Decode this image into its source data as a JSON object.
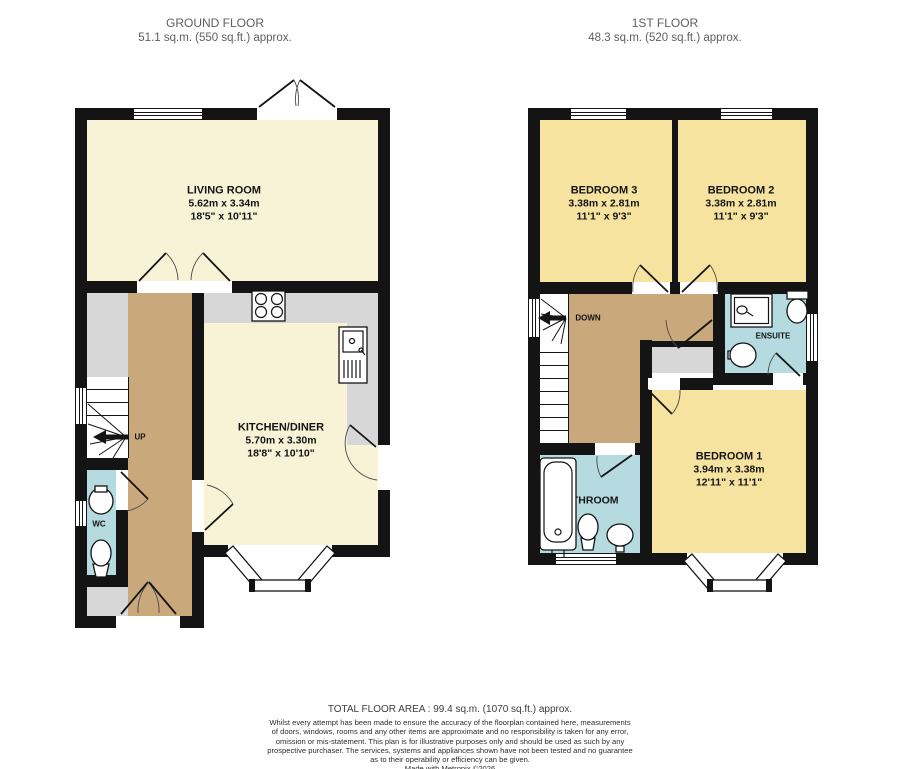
{
  "headers": {
    "ground": {
      "title": "GROUND FLOOR",
      "area": "51.1 sq.m. (550 sq.ft.) approx."
    },
    "first": {
      "title": "1ST FLOOR",
      "area": "48.3 sq.m. (520 sq.ft.) approx."
    }
  },
  "rooms": {
    "living_room": {
      "name": "LIVING ROOM",
      "metric": "5.62m x 3.34m",
      "imperial": "18'5\" x 10'11\""
    },
    "kitchen": {
      "name": "KITCHEN/DINER",
      "metric": "5.70m x 3.30m",
      "imperial": "18'8\" x 10'10\""
    },
    "wc": {
      "name": "WC"
    },
    "bedroom3": {
      "name": "BEDROOM 3",
      "metric": "3.38m x 2.81m",
      "imperial": "11'1\" x 9'3\""
    },
    "bedroom2": {
      "name": "BEDROOM 2",
      "metric": "3.38m x 2.81m",
      "imperial": "11'1\" x 9'3\""
    },
    "bedroom1": {
      "name": "BEDROOM 1",
      "metric": "3.94m x 3.38m",
      "imperial": "12'11\" x 11'1\""
    },
    "bathroom": {
      "name": "BATHROOM"
    },
    "ensuite": {
      "name": "ENSUITE"
    }
  },
  "stairs": {
    "up": "UP",
    "down": "DOWN"
  },
  "footer": {
    "total": "TOTAL FLOOR AREA : 99.4 sq.m. (1070 sq.ft.) approx.",
    "disclaimer": [
      "Whilst every attempt has been made to ensure the accuracy of the floorplan contained here, measurements",
      "of doors, windows, rooms and any other items are approximate and no responsibility is taken for any error,",
      "omission or mis-statement. This plan is for illustrative purposes only and should be used as such by any",
      "prospective purchaser. The services, systems and appliances shown have not been tested and no guarantee",
      "as to their operability or efficiency can be given."
    ],
    "credit": "Made with Metropix ©2026"
  },
  "colors": {
    "room_cream": "#f8f2d7",
    "hall_tan": "#c9a87b",
    "bedroom_yellow": "#f7e3a0",
    "bath_blue": "#b5dbe0",
    "utility_gray": "#d7d7d7",
    "wall": "#141414"
  }
}
